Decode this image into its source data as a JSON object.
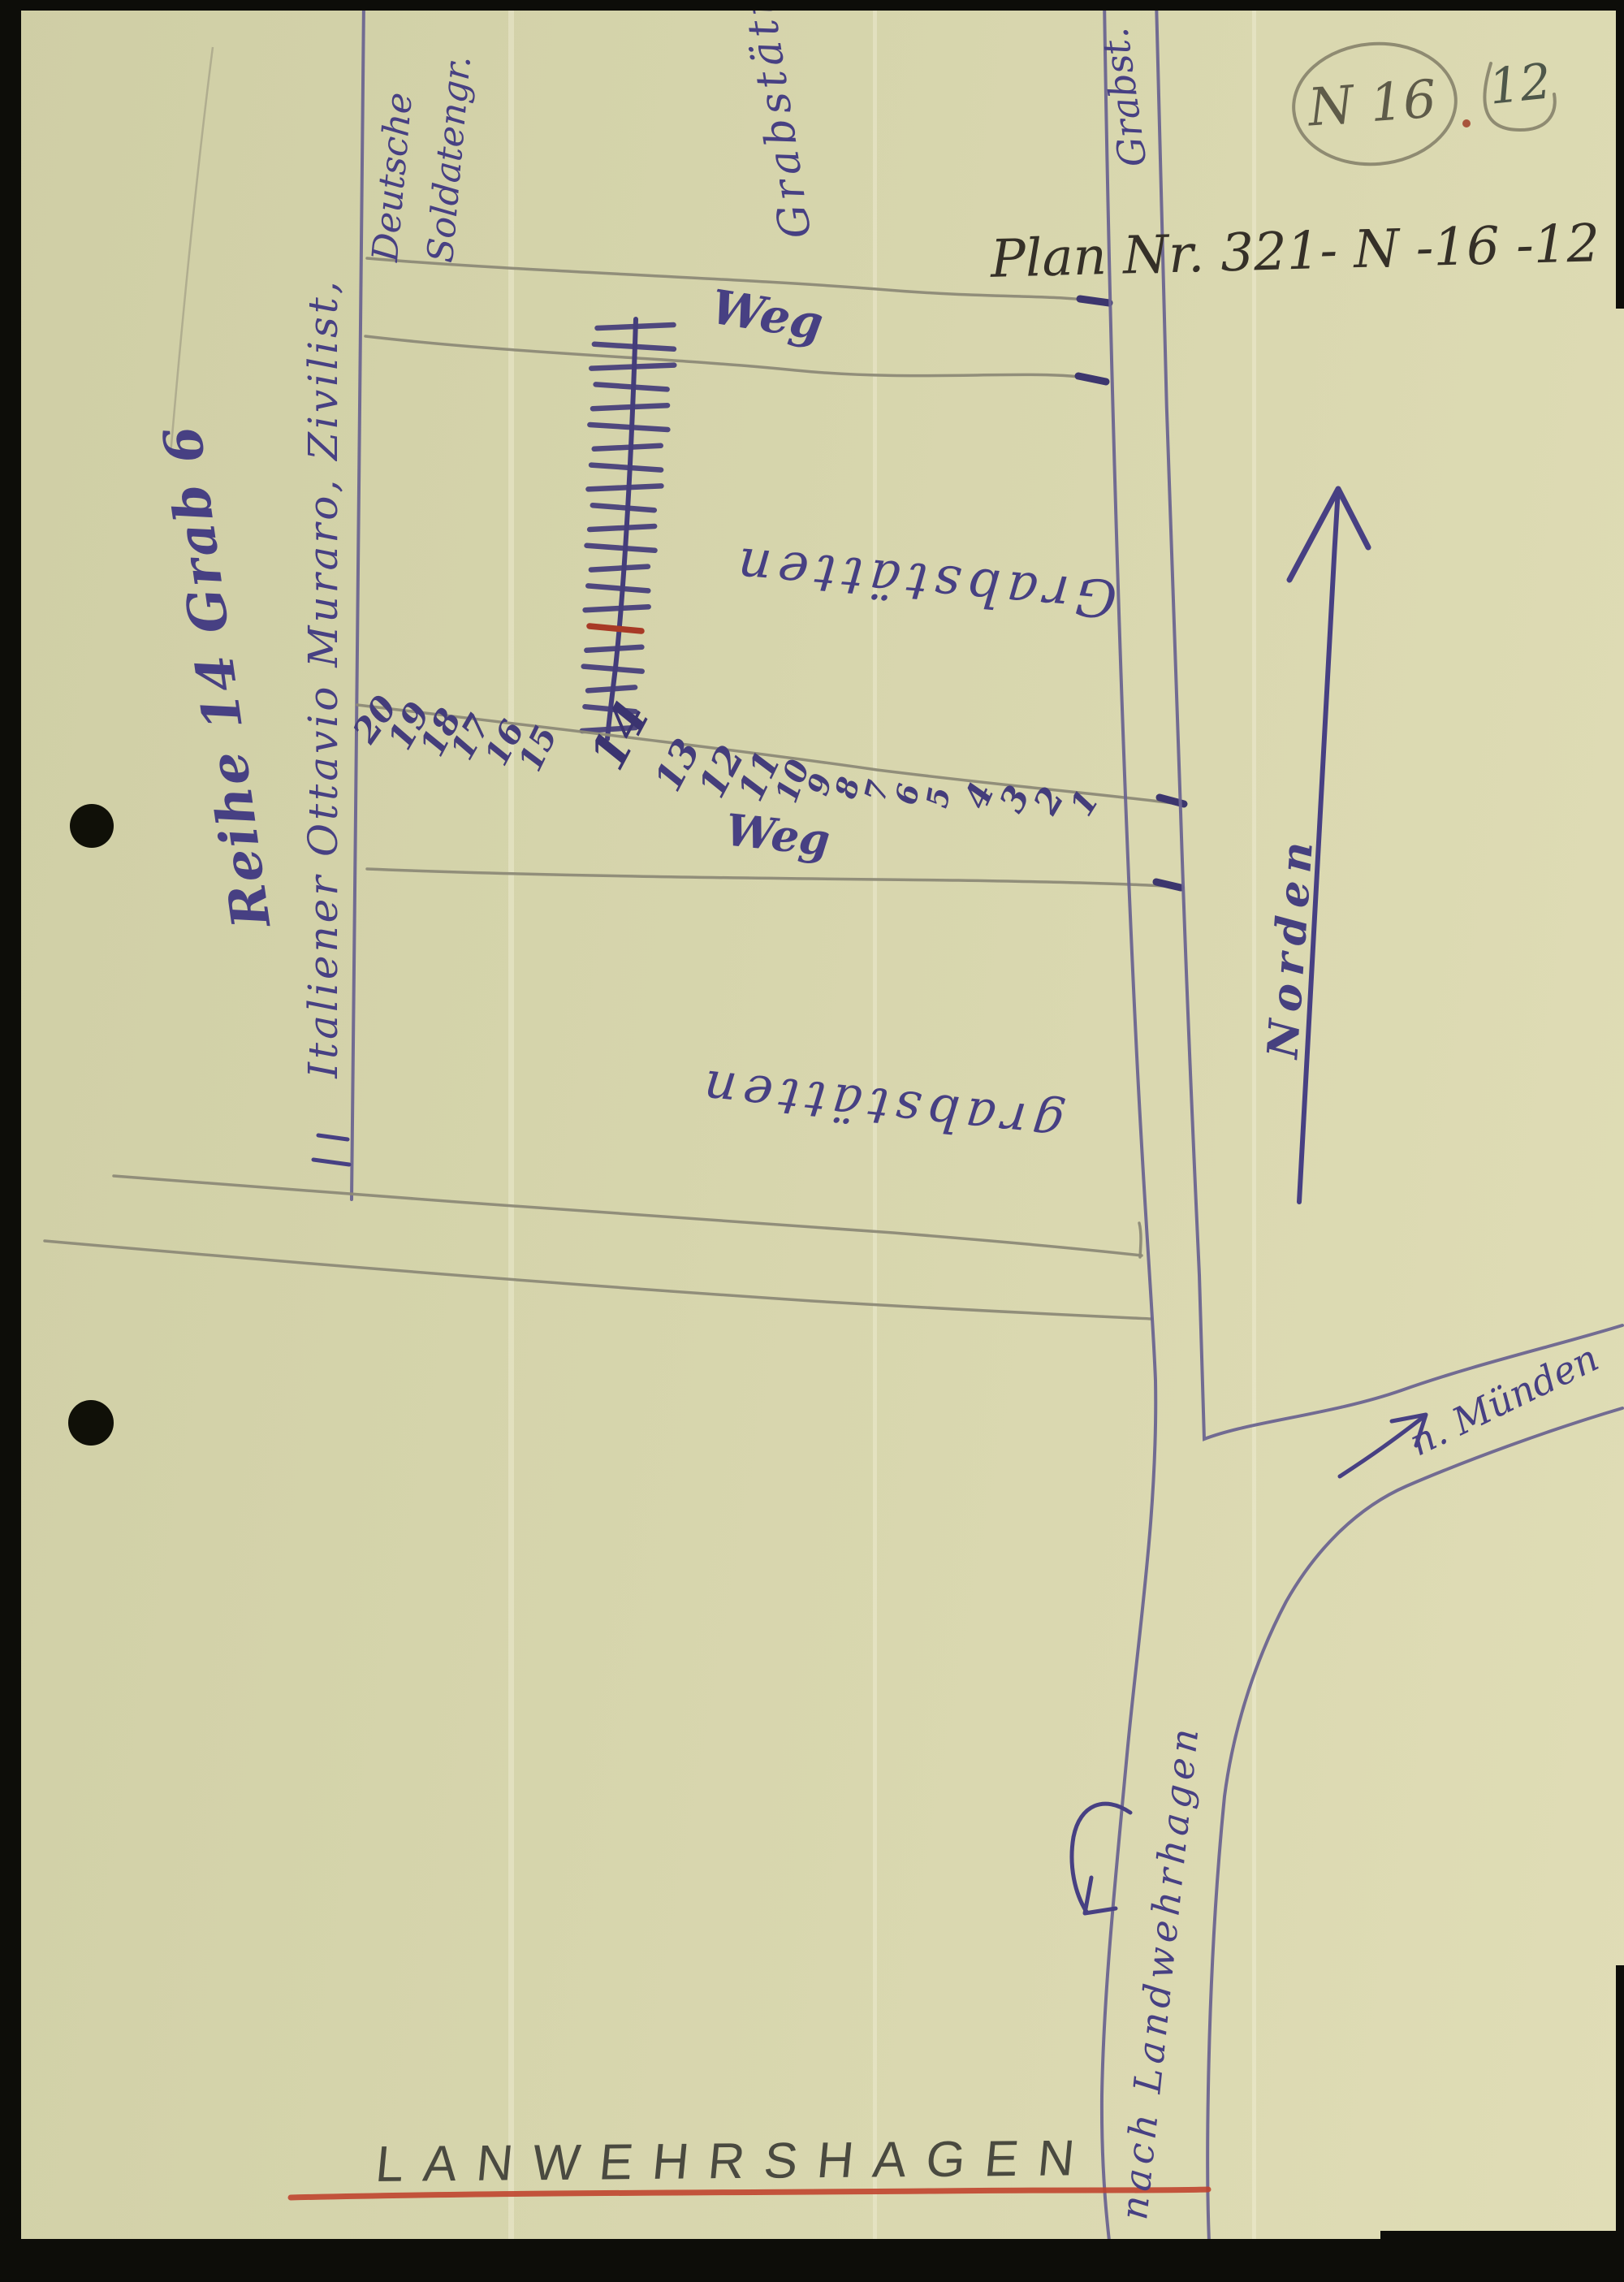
{
  "page": {
    "plan_number": "Plan Nr. 321- N -16 -12",
    "corner_mark_circled": "N 16",
    "corner_mark_page": "12",
    "caption": "LANWEHRSHAGEN"
  },
  "left_margin": {
    "reihe_note": "Reihe 14 Grab 6",
    "italiener_note": "Italiener Ottavio Muraro, Zivilist,"
  },
  "field_labels": {
    "deutsche_line1": "Deutsche",
    "deutsche_line2": "Soldatengr.",
    "grab_top_middle": "Grabstätten",
    "grab_top_right": "Grabst.",
    "grab_upper_field": "Grabstätten",
    "grab_lower_field": "grabstätten",
    "weg_top": "Weg",
    "weg_bottom": "Weg"
  },
  "directions": {
    "north_label": "Norden",
    "muenden_label": "n. Münden",
    "landwehr_road_label": "nach Landwehrhagen"
  },
  "grave_row": {
    "tick_count": 21,
    "red_tick_from_bottom": 6
  },
  "row_numbers": [
    "20",
    "19",
    "18",
    "17",
    "16",
    "15",
    "14",
    "13",
    "12",
    "11",
    "10",
    "9",
    "8",
    "7",
    "6",
    "5",
    "4",
    "3",
    "2",
    "1"
  ],
  "colors": {
    "ink": "#474083",
    "ink2": "#443d7b",
    "pencil": "#8d8a77",
    "road": "#6b6590",
    "red": "#c0452f",
    "red-ink": "#a83a26",
    "graphite": "#4a4a40",
    "paper": "#d5d4ab"
  }
}
